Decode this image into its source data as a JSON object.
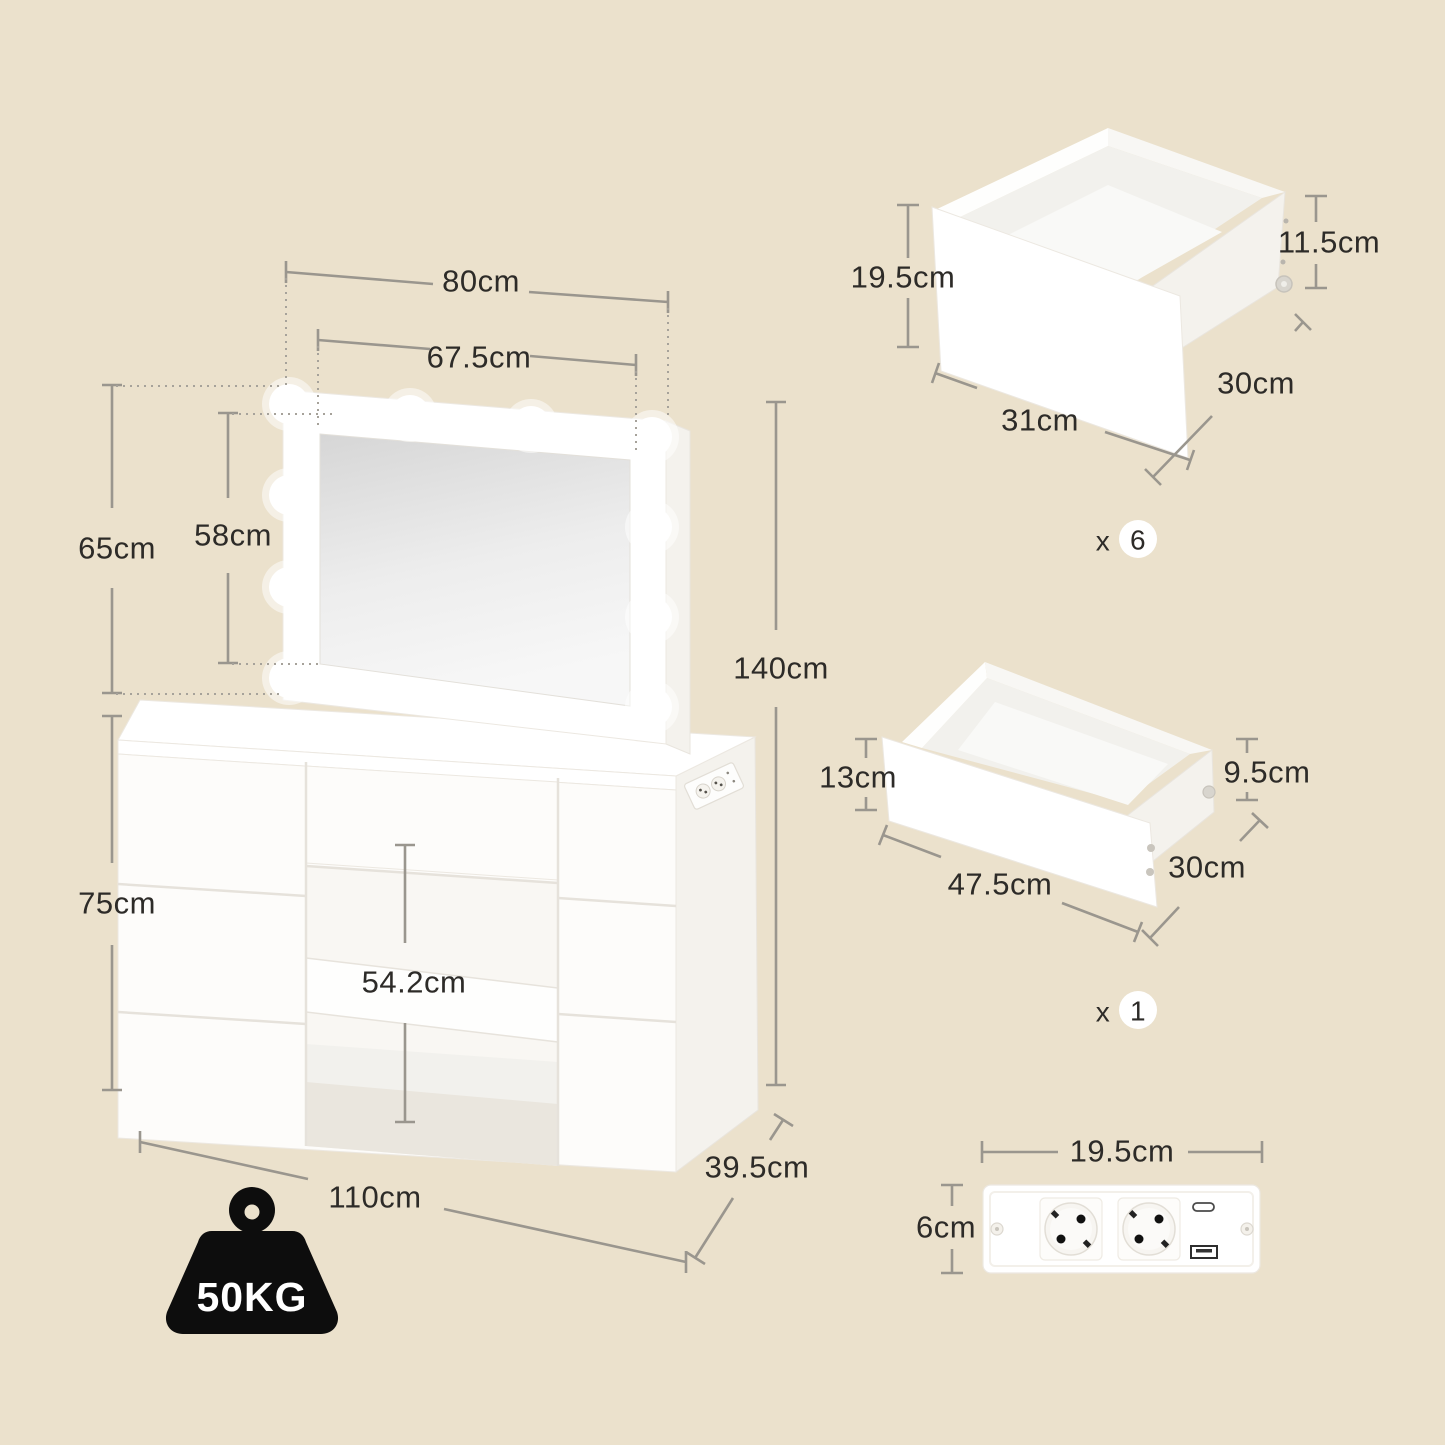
{
  "vanity": {
    "dim_mirror_outer_width": "80cm",
    "dim_mirror_inner_width": "67.5cm",
    "dim_mirror_outer_height": "65cm",
    "dim_mirror_inner_height": "58cm",
    "dim_total_height": "140cm",
    "dim_table_height": "75cm",
    "dim_knee_clearance_height": "54.2cm",
    "dim_table_width": "110cm",
    "dim_table_depth": "39.5cm",
    "max_load_label": "50KG"
  },
  "drawer_small": {
    "dim_front_height": "19.5cm",
    "dim_side_height": "11.5cm",
    "dim_front_width": "31cm",
    "dim_depth": "30cm",
    "quantity_prefix": "x",
    "quantity": "6"
  },
  "drawer_flat": {
    "dim_front_height": "13cm",
    "dim_side_height": "9.5cm",
    "dim_front_width": "47.5cm",
    "dim_depth": "30cm",
    "quantity_prefix": "x",
    "quantity": "1"
  },
  "power_strip": {
    "dim_width": "19.5cm",
    "dim_height": "6cm"
  },
  "icons": {
    "light_bulb": "light-bulb-icon",
    "socket": "eu-socket-icon",
    "usb_c": "usb-c-port-icon",
    "usb_a": "usb-a-port-icon",
    "weight": "weight-kettlebell-icon"
  },
  "colors": {
    "background": "#EBE1CC",
    "dimension_line": "#9A968E",
    "label_text": "#2D2B28",
    "furniture_white": "#FFFFFF",
    "weight_icon": "#0D0D0D",
    "mirror_glass_top": "#D6D6D6",
    "mirror_glass_bottom": "#F7F7F7"
  }
}
